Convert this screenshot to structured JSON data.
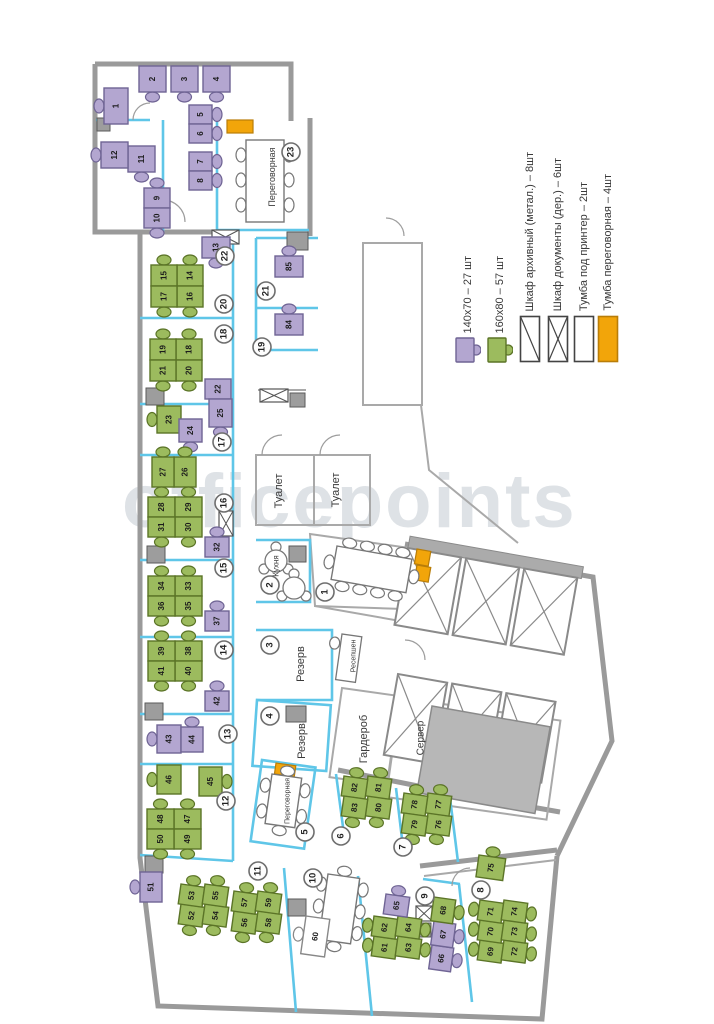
{
  "watermark": "officepoints",
  "colors": {
    "desk_140x70": "#b3a6d0",
    "desk_140x70_border": "#6f6494",
    "desk_160x80": "#9cbb5e",
    "desk_160x80_border": "#5b7427",
    "accent_orange": "#f2a50a",
    "wall_gray": "#9a9a9a",
    "partition_cyan": "#5fc6e8"
  },
  "legend": {
    "items": [
      {
        "icon": "desk-140",
        "label": "140х70 – 27 шт"
      },
      {
        "icon": "desk-160",
        "label": "160х80 – 57 шт"
      },
      {
        "icon": "cabinet-diagonal",
        "label": "Шкаф архивный (метал.) – 8шт"
      },
      {
        "icon": "cabinet-cross",
        "label": "Шкаф документы (дер.) – 6шт"
      },
      {
        "icon": "cabinet-plain",
        "label": "Тумба под принтер – 2шт"
      },
      {
        "icon": "cabinet-orange",
        "label": "Тумба переговорная – 4шт"
      }
    ]
  },
  "plan": {
    "room_numbers": [
      "1",
      "2",
      "3",
      "4",
      "5",
      "6",
      "7",
      "8",
      "9",
      "10",
      "11",
      "12",
      "13",
      "14",
      "15",
      "16",
      "17",
      "18",
      "19",
      "20",
      "21",
      "22",
      "23"
    ],
    "room_labels": [
      {
        "id": "meeting-23",
        "text": "Переговорная"
      },
      {
        "id": "toilet-a",
        "text": "Туалет"
      },
      {
        "id": "toilet-b",
        "text": "Туалет"
      },
      {
        "id": "kitchen",
        "text": "Кухня"
      },
      {
        "id": "reserve-3",
        "text": "Резерв"
      },
      {
        "id": "reserve-4",
        "text": "Резерв"
      },
      {
        "id": "meeting-5",
        "text": "Переговорная"
      },
      {
        "id": "reception",
        "text": "Ресепшен"
      },
      {
        "id": "wardrobe",
        "text": "Гардероб"
      },
      {
        "id": "server",
        "text": "Сервер"
      }
    ],
    "desks": [
      {
        "n": 1,
        "type": "140x70"
      },
      {
        "n": 2,
        "type": "140x70"
      },
      {
        "n": 3,
        "type": "140x70"
      },
      {
        "n": 4,
        "type": "140x70"
      },
      {
        "n": 5,
        "type": "140x70"
      },
      {
        "n": 6,
        "type": "140x70"
      },
      {
        "n": 7,
        "type": "140x70"
      },
      {
        "n": 8,
        "type": "140x70"
      },
      {
        "n": 9,
        "type": "140x70"
      },
      {
        "n": 10,
        "type": "140x70"
      },
      {
        "n": 11,
        "type": "140x70"
      },
      {
        "n": 12,
        "type": "140x70"
      },
      {
        "n": 13,
        "type": "140x70"
      },
      {
        "n": 14,
        "type": "160x80"
      },
      {
        "n": 15,
        "type": "160x80"
      },
      {
        "n": 16,
        "type": "160x80"
      },
      {
        "n": 17,
        "type": "160x80"
      },
      {
        "n": 18,
        "type": "160x80"
      },
      {
        "n": 19,
        "type": "160x80"
      },
      {
        "n": 20,
        "type": "160x80"
      },
      {
        "n": 21,
        "type": "160x80"
      },
      {
        "n": 22,
        "type": "140x70"
      },
      {
        "n": 23,
        "type": "160x80"
      },
      {
        "n": 24,
        "type": "140x70"
      },
      {
        "n": 25,
        "type": "140x70"
      },
      {
        "n": 26,
        "type": "160x80"
      },
      {
        "n": 27,
        "type": "160x80"
      },
      {
        "n": 28,
        "type": "160x80"
      },
      {
        "n": 29,
        "type": "160x80"
      },
      {
        "n": 30,
        "type": "160x80"
      },
      {
        "n": 31,
        "type": "160x80"
      },
      {
        "n": 32,
        "type": "140x70"
      },
      {
        "n": 33,
        "type": "160x80"
      },
      {
        "n": 34,
        "type": "160x80"
      },
      {
        "n": 35,
        "type": "160x80"
      },
      {
        "n": 36,
        "type": "160x80"
      },
      {
        "n": 37,
        "type": "140x70"
      },
      {
        "n": 38,
        "type": "160x80"
      },
      {
        "n": 39,
        "type": "160x80"
      },
      {
        "n": 40,
        "type": "160x80"
      },
      {
        "n": 41,
        "type": "160x80"
      },
      {
        "n": 42,
        "type": "140x70"
      },
      {
        "n": 43,
        "type": "140x70"
      },
      {
        "n": 44,
        "type": "140x70"
      },
      {
        "n": 45,
        "type": "160x80"
      },
      {
        "n": 46,
        "type": "160x80"
      },
      {
        "n": 47,
        "type": "160x80"
      },
      {
        "n": 48,
        "type": "160x80"
      },
      {
        "n": 49,
        "type": "160x80"
      },
      {
        "n": 50,
        "type": "160x80"
      },
      {
        "n": 51,
        "type": "140x70"
      },
      {
        "n": 52,
        "type": "160x80"
      },
      {
        "n": 53,
        "type": "160x80"
      },
      {
        "n": 54,
        "type": "160x80"
      },
      {
        "n": 55,
        "type": "160x80"
      },
      {
        "n": 56,
        "type": "160x80"
      },
      {
        "n": 57,
        "type": "160x80"
      },
      {
        "n": 58,
        "type": "160x80"
      },
      {
        "n": 59,
        "type": "160x80"
      },
      {
        "n": 60,
        "type": "staff"
      },
      {
        "n": 61,
        "type": "160x80"
      },
      {
        "n": 62,
        "type": "160x80"
      },
      {
        "n": 63,
        "type": "160x80"
      },
      {
        "n": 64,
        "type": "160x80"
      },
      {
        "n": 65,
        "type": "140x70"
      },
      {
        "n": 66,
        "type": "140x70"
      },
      {
        "n": 67,
        "type": "140x70"
      },
      {
        "n": 68,
        "type": "160x80"
      },
      {
        "n": 69,
        "type": "160x80"
      },
      {
        "n": 70,
        "type": "160x80"
      },
      {
        "n": 71,
        "type": "160x80"
      },
      {
        "n": 72,
        "type": "160x80"
      },
      {
        "n": 73,
        "type": "160x80"
      },
      {
        "n": 74,
        "type": "160x80"
      },
      {
        "n": 75,
        "type": "160x80"
      },
      {
        "n": 76,
        "type": "160x80"
      },
      {
        "n": 77,
        "type": "160x80"
      },
      {
        "n": 78,
        "type": "160x80"
      },
      {
        "n": 79,
        "type": "160x80"
      },
      {
        "n": 80,
        "type": "160x80"
      },
      {
        "n": 81,
        "type": "160x80"
      },
      {
        "n": 82,
        "type": "160x80"
      },
      {
        "n": 83,
        "type": "160x80"
      },
      {
        "n": 84,
        "type": "140x70"
      },
      {
        "n": 85,
        "type": "140x70"
      }
    ]
  }
}
